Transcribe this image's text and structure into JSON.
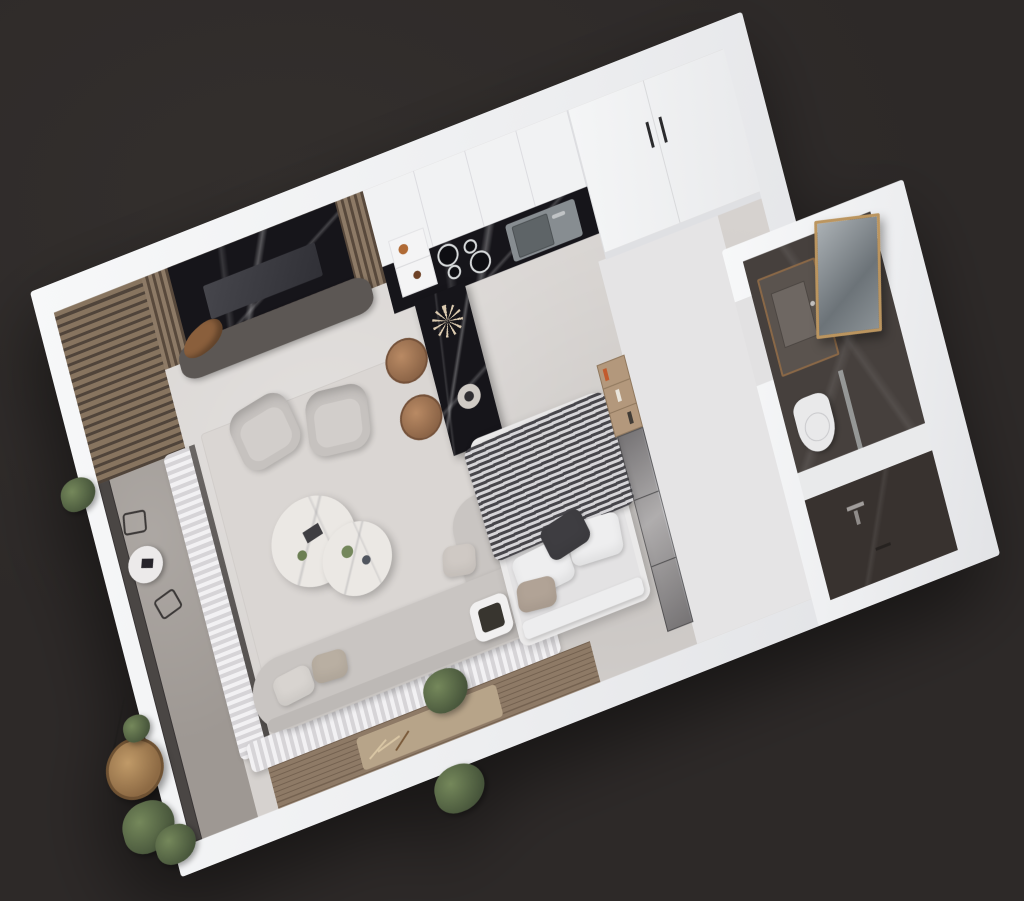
{
  "scene": {
    "kind": "3d-floorplan-render",
    "subject": "studio-apartment-top-down-cutaway",
    "background_color": "#2d2928",
    "palette": {
      "outer_wall_white": "#eff0f1",
      "floor_concrete": "#d6d2cf",
      "corridor_floor": "#e5e4e5",
      "area_rug": "#dad6d3",
      "balcony_stone": "#9e9893",
      "deck_wood": "#8e7a66",
      "jute_rug": "#b7a489",
      "wood_slat_light": "#8d7a66",
      "wood_slat_dark": "#58493c",
      "marble_black": "#16151a",
      "marble_white": "#ebe8e4",
      "cabinet_white": "#f1f2f3",
      "wardrobe_white": "#f4f5f6",
      "console_gray": "#5c5754",
      "tv_screen": "#3c3c42",
      "sink_steel": "#878d91",
      "sofa_fabric": "#c9c5c2",
      "armchair_fabric": "#c6c2bf",
      "cushion_beige": "#b9afa2",
      "duvet_stripe_dark": "#47464b",
      "duvet_stripe_light": "#d6d5d8",
      "pillow_white": "#eeeeef",
      "pillow_dark": "#3e3d41",
      "pillow_beige": "#b1a396",
      "stool_leather": "#b98a64",
      "curtain_light": "#f2f1f3",
      "curtain_shadow": "#d6d4d7",
      "glass_dark": "#4a4644",
      "bath_tile": "#46403d",
      "shower_tile": "#38322f",
      "vanity_wood_trim": "#8a6847",
      "mirror_brass": "#bb955f",
      "toilet_white": "#e9e9ea",
      "plant_green": "#75885b",
      "rattan": "#c09a68",
      "driftwood": "#8a5f3c"
    },
    "rooms": [
      {
        "id": "kitchen",
        "items": [
          "upper-cabinets",
          "black-marble-counter",
          "steel-sink",
          "faucet",
          "induction-hob",
          "niche-shelf-with-bowls",
          "marble-island-bar",
          "bar-stool",
          "bar-stool",
          "dried-flower-decor",
          "tall-wardrobe"
        ]
      },
      {
        "id": "living-area",
        "items": [
          "wood-slat-tv-wall",
          "black-marble-tv-panel",
          "tv",
          "media-console",
          "driftwood-decor",
          "area-rug",
          "armchair",
          "armchair",
          "round-coffee-table",
          "round-coffee-table",
          "l-shaped-sofa",
          "throw-cushions",
          "olive-plant"
        ]
      },
      {
        "id": "sleeping-area",
        "items": [
          "double-bed",
          "striped-duvet",
          "white-pillow",
          "white-pillow",
          "dark-pillow",
          "beige-pillow",
          "foot-bench",
          "tray-side-table",
          "open-shelving",
          "glass-wardrobe-partition"
        ]
      },
      {
        "id": "bathroom",
        "items": [
          "dark-marble-floor",
          "stone-vanity",
          "vessel-sink",
          "brass-framed-mirror",
          "toilet",
          "glass-screen",
          "walk-in-shower",
          "shower-handle",
          "drain"
        ]
      },
      {
        "id": "balcony",
        "items": [
          "glazed-facade",
          "stone-floor",
          "pergola-slats",
          "bistro-table",
          "metal-chair",
          "metal-chair",
          "sheer-curtains",
          "sliding-glass-door",
          "wood-deck",
          "jute-rug",
          "pampas-decor",
          "hanging-egg-chair",
          "outdoor-plants"
        ]
      }
    ],
    "view": {
      "style": "axonometric-cutaway",
      "plan_tilt": "rotated-counterclockwise"
    }
  }
}
